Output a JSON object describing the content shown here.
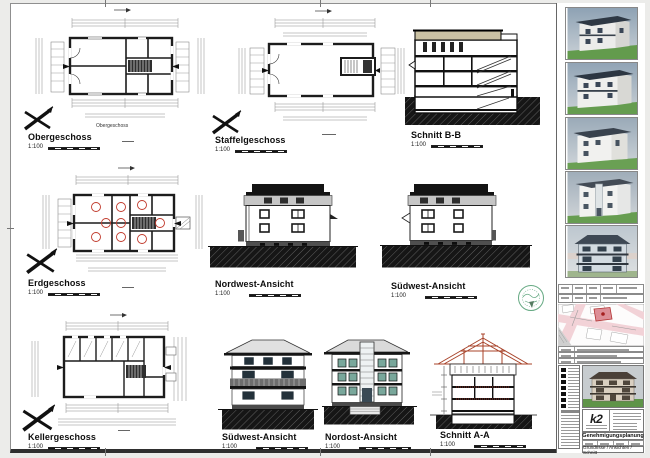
{
  "panels": {
    "obergeschoss": {
      "title": "Obergeschoss",
      "scale": "1:100",
      "caption": "Obergeschoss"
    },
    "staffelgeschoss": {
      "title": "Staffelgeschoss",
      "scale": "1:100"
    },
    "schnitt_bb": {
      "title": "Schnitt B-B",
      "scale": "1:100"
    },
    "erdgeschoss": {
      "title": "Erdgeschoss",
      "scale": "1:100"
    },
    "nordwest_ansicht": {
      "title": "Nordwest-Ansicht",
      "scale": "1:100"
    },
    "suedwest_ansicht_mitte": {
      "title": "Südwest-Ansicht",
      "scale": "1:100"
    },
    "kellergeschoss": {
      "title": "Kellergeschoss",
      "scale": "1:100"
    },
    "suedwest_ansicht_unten": {
      "title": "Südwest-Ansicht",
      "scale": "1:100"
    },
    "nordost_ansicht": {
      "title": "Nordost-Ansicht",
      "scale": "1:100"
    },
    "schnitt_aa": {
      "title": "Schnitt A-A",
      "scale": "1:100"
    }
  },
  "renders": {
    "count": 5
  },
  "title_block": {
    "logo_text": "k2",
    "phase_title": "Genehmigungsplanung",
    "content_title": "Grundrisse / Ansichten / Schnitt"
  },
  "colors": {
    "ink": "#1a1a1a",
    "roof_tan": "#c9c0a2",
    "roof_red": "#a8432a",
    "marker_red": "#c0392b",
    "stamp_green": "#3f9464",
    "map_pink": "#f2d2d7",
    "map_parcel": "#dd8f97",
    "render_sky": "#9aabbc",
    "render_grass": "#609a4b"
  }
}
